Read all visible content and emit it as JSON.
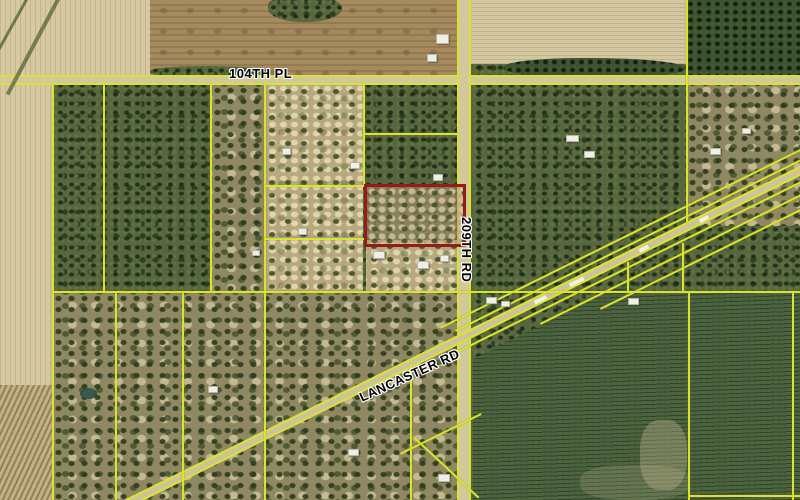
{
  "map": {
    "road_labels": {
      "pl104": "104TH PL",
      "rd209": "209TH RD",
      "lancaster": "LANCASTER RD"
    },
    "highlighted_parcel": {
      "outline_color": "#951c18"
    },
    "colors": {
      "parcel_line": "#dae32f",
      "woods": "#57663e",
      "woods_dark": "#3c5230",
      "clearing": "#b7a87e",
      "field_light": "#d6c9a2",
      "field_brown": "#a5895f",
      "pine_plantation": "#4a6140",
      "road_surface": "#d2c89e",
      "label_text": "#000000",
      "label_halo": "#ffffff"
    }
  }
}
